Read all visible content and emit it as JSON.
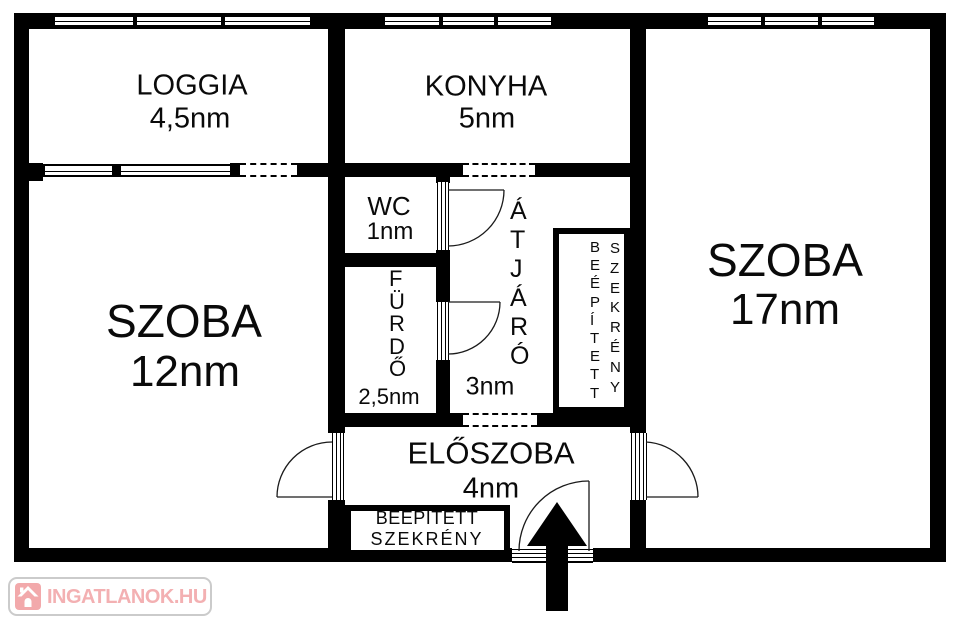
{
  "floorplan": {
    "rooms": {
      "loggia": {
        "name": "LOGGIA",
        "area": "4,5nm"
      },
      "konyha": {
        "name": "KONYHA",
        "area": "5nm"
      },
      "wc": {
        "name": "WC",
        "area": "1nm"
      },
      "szoba_left": {
        "name": "SZOBA",
        "area": "12nm"
      },
      "furdo": {
        "name": "FÜRDŐ",
        "area": "2,5nm"
      },
      "atjaro": {
        "name": "ÁTJÁRÓ",
        "area": "3nm"
      },
      "szoba_right": {
        "name": "SZOBA",
        "area": "17nm"
      },
      "eloszoba": {
        "name": "ELŐSZOBA",
        "area": "4nm"
      }
    },
    "closets": {
      "atjaro_closet": {
        "word1": "BEÉPÍTETT",
        "word2": "SZEKRÉNY"
      },
      "eloszoba_closet": {
        "line1": "BEEPITETT",
        "line2": "SZEKRÉNY"
      }
    },
    "entrance_arrow_icon": "entrance-arrow"
  },
  "watermark": {
    "text": "INGATLANOK.HU",
    "icon": "house-icon",
    "colors": {
      "pink": "#f2a9ab",
      "border": "#cbcbcb",
      "background": "#ffffff"
    }
  },
  "colors": {
    "wall": "#000000",
    "background": "#ffffff",
    "doorline": "#1a1a1a"
  }
}
